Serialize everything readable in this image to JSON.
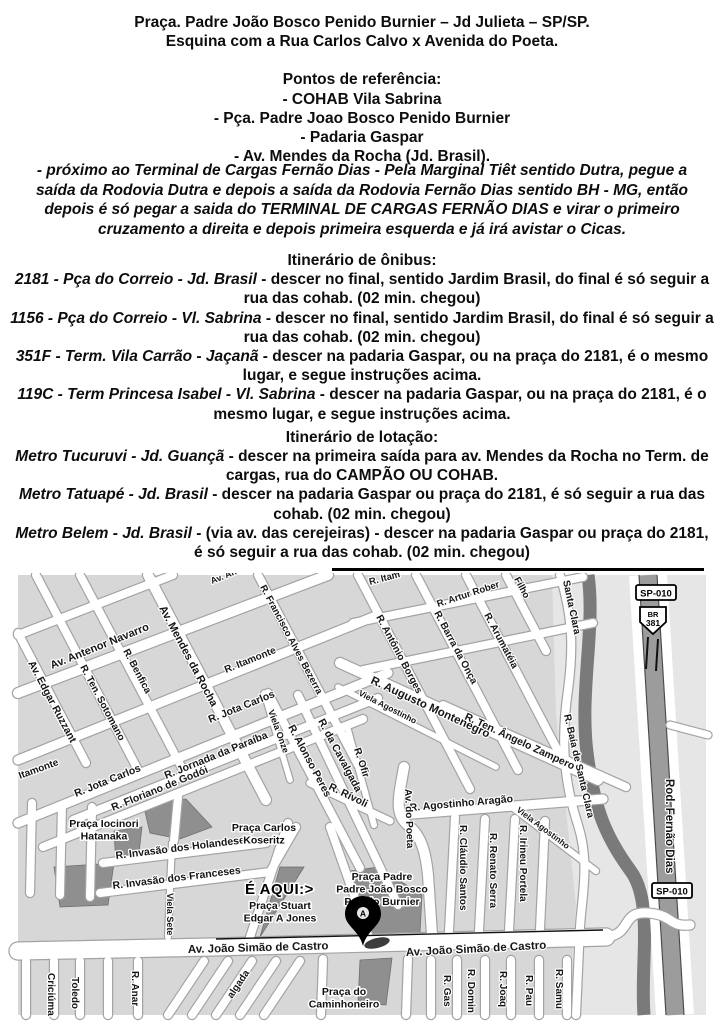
{
  "doc": {
    "title_line1": "Praça. Padre João Bosco Penido Burnier – Jd Julieta – SP/SP.",
    "title_line2": "Esquina com a Rua Carlos Calvo x Avenida do Poeta.",
    "referencias": {
      "heading": "Pontos de referência:",
      "items": [
        "- COHAB Vila Sabrina",
        "- Pça. Padre Joao Bosco Penido Burnier",
        "- Padaria Gaspar",
        "- Av. Mendes da Rocha (Jd. Brasil)."
      ]
    },
    "driving_note": "- próximo ao Terminal de Cargas Fernão Dias - Pela Marginal Tiêt sentido Dutra, pegue a saída da Rodovia Dutra e depois a saída da Rodovia Fernão Dias sentido BH - MG, então depois é só pegar a saida do TERMINAL DE CARGAS FERNÃO DIAS e virar o primeiro cruzamento a direita e depois primeira esquerda e já irá avistar o Cicas.",
    "onibus": {
      "heading": "Itinerário de ônibus:",
      "routes": [
        {
          "name": "2181 - Pça do Correio - Jd. Brasil",
          "desc": " - descer no final, sentido Jardim Brasil, do final é só seguir a rua das cohab. (02 min. chegou)"
        },
        {
          "name": "1156 - Pça do Correio - Vl. Sabrina",
          "desc": " - descer no final, sentido Jardim Brasil, do final é só seguir a rua das cohab. (02 min. chegou)"
        },
        {
          "name": "351F - Term. Vila Carrão - Jaçanã",
          "desc": " - descer na padaria Gaspar, ou na praça do 2181, é o mesmo lugar, e segue instruções acima."
        },
        {
          "name": "119C - Term Princesa Isabel - Vl. Sabrina",
          "desc": " - descer na padaria Gaspar, ou na praça do 2181, é o mesmo lugar, e segue instruções acima."
        }
      ]
    },
    "lotacao": {
      "heading": "Itinerário de lotação:",
      "routes": [
        {
          "name": "Metro Tucuruvi - Jd. Guançã",
          "desc": " - descer na primeira saída para av. Mendes da Rocha no Term. de cargas, rua do CAMPÃO OU COHAB."
        },
        {
          "name": "Metro Tatuapé - Jd. Brasil",
          "desc": " - descer na padaria Gaspar ou praça do 2181, é só seguir a rua das cohab. (02 min. chegou)"
        },
        {
          "name": "Metro Belem - Jd. Brasil",
          "desc": " - (via av. das cerejeiras) - descer na padaria Gaspar ou praça do 2181, é só seguir a rua das cohab. (02 min. chegou)"
        }
      ]
    }
  },
  "map": {
    "here_label": "É AQUI:>",
    "marker_letter": "A",
    "badges": {
      "sp010": "SP-010",
      "br_line1": "BR",
      "br_line2": "381"
    },
    "colors": {
      "block": "#d7d7d7",
      "street": "#ffffff",
      "praca": "#8f8f8f",
      "river": "#7a7a7a",
      "highway": "#9c9c9c"
    },
    "street_labels": [
      {
        "t": "Av. An",
        "x": 194,
        "y": 9,
        "r": -22,
        "s": 9
      },
      {
        "t": "R. Itam",
        "x": 352,
        "y": 10,
        "r": -15,
        "s": 9.5
      },
      {
        "t": "R. Artur Rober",
        "x": 420,
        "y": 32,
        "r": -18,
        "s": 9.5
      },
      {
        "t": "Filho",
        "x": 496,
        "y": 4,
        "r": 62,
        "s": 9.5
      },
      {
        "t": "Santa Clara",
        "x": 545,
        "y": 6,
        "r": 78,
        "s": 10
      },
      {
        "t": "Av. Antenor Navarro",
        "x": 34,
        "y": 94,
        "r": -22,
        "s": 11
      },
      {
        "t": "Av. Edgar Ruzzant",
        "x": 10,
        "y": 88,
        "r": 62,
        "s": 10.5
      },
      {
        "t": "R. Ten. Sotomano",
        "x": 62,
        "y": 92,
        "r": 62,
        "s": 10
      },
      {
        "t": "R. Benfica",
        "x": 105,
        "y": 76,
        "r": 62,
        "s": 10
      },
      {
        "t": "Av. Mendes da Rocha",
        "x": 141,
        "y": 33,
        "r": 62,
        "s": 11
      },
      {
        "t": "R. Itamonte",
        "x": 208,
        "y": 98,
        "r": -22,
        "s": 10
      },
      {
        "t": "Itamonte",
        "x": 2,
        "y": 204,
        "r": -20,
        "s": 10
      },
      {
        "t": "R. Francisco Alves Bezerra",
        "x": 242,
        "y": 12,
        "r": 62,
        "s": 9.5
      },
      {
        "t": "R. Jota Carlos",
        "x": 192,
        "y": 148,
        "r": -22,
        "s": 10.5
      },
      {
        "t": "R. Jota Carlos",
        "x": 58,
        "y": 222,
        "r": -22,
        "s": 10.5
      },
      {
        "t": "Viela Onze",
        "x": 250,
        "y": 136,
        "r": 70,
        "s": 9
      },
      {
        "t": "R. Jornada da Paraíba",
        "x": 148,
        "y": 204,
        "r": -22,
        "s": 10.5
      },
      {
        "t": "R. Floriano de Godói",
        "x": 95,
        "y": 236,
        "r": -22,
        "s": 10.5
      },
      {
        "t": "R. Alonso Peres",
        "x": 270,
        "y": 152,
        "r": 62,
        "s": 10.5
      },
      {
        "t": "R. da Cavalgada",
        "x": 300,
        "y": 146,
        "r": 62,
        "s": 10.5
      },
      {
        "t": "R. Ofir",
        "x": 336,
        "y": 174,
        "r": 72,
        "s": 10
      },
      {
        "t": "R. Rívoli",
        "x": 310,
        "y": 214,
        "r": 26,
        "s": 10.5
      },
      {
        "t": "Viela Agostinho",
        "x": 340,
        "y": 120,
        "r": 27,
        "s": 8.5
      },
      {
        "t": "R. Augusto Montenegro",
        "x": 352,
        "y": 108,
        "r": 25,
        "s": 11.5
      },
      {
        "t": "R. Antônio Borges",
        "x": 358,
        "y": 42,
        "r": 62,
        "s": 10
      },
      {
        "t": "R. Barra da Onça",
        "x": 416,
        "y": 38,
        "r": 62,
        "s": 10
      },
      {
        "t": "R. Arumatéia",
        "x": 466,
        "y": 40,
        "r": 62,
        "s": 10
      },
      {
        "t": "R. Ten. Ângelo Zampero",
        "x": 446,
        "y": 144,
        "r": 25,
        "s": 10.5
      },
      {
        "t": "R. Baía de Santa Clara",
        "x": 546,
        "y": 140,
        "r": 77,
        "s": 10
      },
      {
        "t": "Viela Agostinho",
        "x": 498,
        "y": 236,
        "r": 37,
        "s": 8.5
      },
      {
        "t": "R. Agostinho Aragão",
        "x": 392,
        "y": 236,
        "r": -5,
        "s": 10.5
      },
      {
        "t": "Av. do Poeta",
        "x": 387,
        "y": 214,
        "r": 88,
        "s": 10
      },
      {
        "t": "R. Cláudio Santos",
        "x": 442,
        "y": 250,
        "r": 90,
        "s": 10
      },
      {
        "t": "R. Renato Serra",
        "x": 472,
        "y": 258,
        "r": 90,
        "s": 10
      },
      {
        "t": "R. Irineu Portela",
        "x": 502,
        "y": 250,
        "r": 90,
        "s": 10
      },
      {
        "t": "R. Invasão dos Holandeses",
        "x": 98,
        "y": 284,
        "r": -7,
        "s": 10.5
      },
      {
        "t": "R. Invasão dos Franceses",
        "x": 95,
        "y": 314,
        "r": -7,
        "s": 10.5
      },
      {
        "t": "Viela Sete",
        "x": 149,
        "y": 318,
        "r": 90,
        "s": 9
      },
      {
        "t": "Av. João Simão de Castro",
        "x": 170,
        "y": 378,
        "r": -1.5,
        "s": 11.5
      },
      {
        "t": "Av. João Simão de Castro",
        "x": 388,
        "y": 381,
        "r": -3,
        "s": 11.5
      },
      {
        "t": "Rod. Fernão Dias",
        "x": 648,
        "y": 204,
        "r": 90,
        "s": 11.5
      },
      {
        "t": "algada",
        "x": 214,
        "y": 424,
        "r": -56,
        "s": 10
      },
      {
        "t": "Criciúma",
        "x": 30,
        "y": 398,
        "r": 90,
        "s": 10
      },
      {
        "t": "Toledo",
        "x": 54,
        "y": 402,
        "r": 90,
        "s": 10
      },
      {
        "t": "R. Anar",
        "x": 114,
        "y": 396,
        "r": 90,
        "s": 10
      },
      {
        "t": "R. Gas",
        "x": 426,
        "y": 400,
        "r": 90,
        "s": 10
      },
      {
        "t": "R. Domin",
        "x": 450,
        "y": 394,
        "r": 90,
        "s": 10
      },
      {
        "t": "R. Joaq",
        "x": 482,
        "y": 396,
        "r": 90,
        "s": 10
      },
      {
        "t": "R. Pau",
        "x": 508,
        "y": 400,
        "r": 90,
        "s": 10
      },
      {
        "t": "R. Samu",
        "x": 538,
        "y": 394,
        "r": 90,
        "s": 10
      }
    ],
    "place_labels": [
      {
        "lines": [
          "Praça Iocinori",
          "Hatanaka"
        ],
        "x": 86,
        "y": 252,
        "s": 10.5
      },
      {
        "lines": [
          "Praça Carlos",
          "Koseritz"
        ],
        "x": 246,
        "y": 256,
        "s": 10.5
      },
      {
        "lines": [
          "Praça Stuart",
          "Edgar A Jones"
        ],
        "x": 262,
        "y": 334,
        "s": 10.5
      },
      {
        "lines": [
          "Praça Padre",
          "Padre João Bosco",
          "Penido Burnier"
        ],
        "x": 364,
        "y": 305,
        "s": 10.5
      },
      {
        "lines": [
          "Praça do",
          "Caminhoneiro"
        ],
        "x": 326,
        "y": 420,
        "s": 10.5
      }
    ]
  }
}
